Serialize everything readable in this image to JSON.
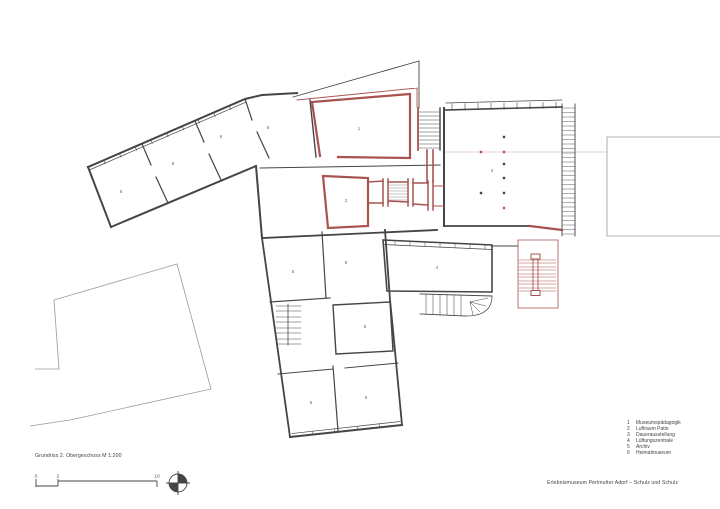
{
  "sheet": {
    "caption": "Grundriss 2. Obergeschoss M 1:200",
    "project_title": "Erlebnismuseum Perlmutter Adorf – Schulz und Schulz"
  },
  "scale_bar": {
    "ticks": [
      "0",
      "2",
      "10"
    ]
  },
  "legend": {
    "items": [
      {
        "num": "1",
        "label": "Museumspädagogik"
      },
      {
        "num": "2",
        "label": "Luftraum Patio"
      },
      {
        "num": "3",
        "label": "Dauerausstellung"
      },
      {
        "num": "4",
        "label": "Lüftungszentrale"
      },
      {
        "num": "5",
        "label": "Archiv"
      },
      {
        "num": "6",
        "label": "Heimatmuseum"
      }
    ]
  },
  "plan": {
    "room_markers": [
      {
        "label": "1"
      },
      {
        "label": "2"
      },
      {
        "label": "3"
      },
      {
        "label": "4"
      },
      {
        "label": "5"
      },
      {
        "label": "5"
      },
      {
        "label": "5"
      },
      {
        "label": "5"
      },
      {
        "label": "5"
      },
      {
        "label": "6"
      },
      {
        "label": "6"
      },
      {
        "label": "6"
      },
      {
        "label": "6"
      }
    ],
    "colors": {
      "new_construction": "#a8534f",
      "existing_walls": "#454545",
      "context": "#9a9a9a"
    }
  }
}
